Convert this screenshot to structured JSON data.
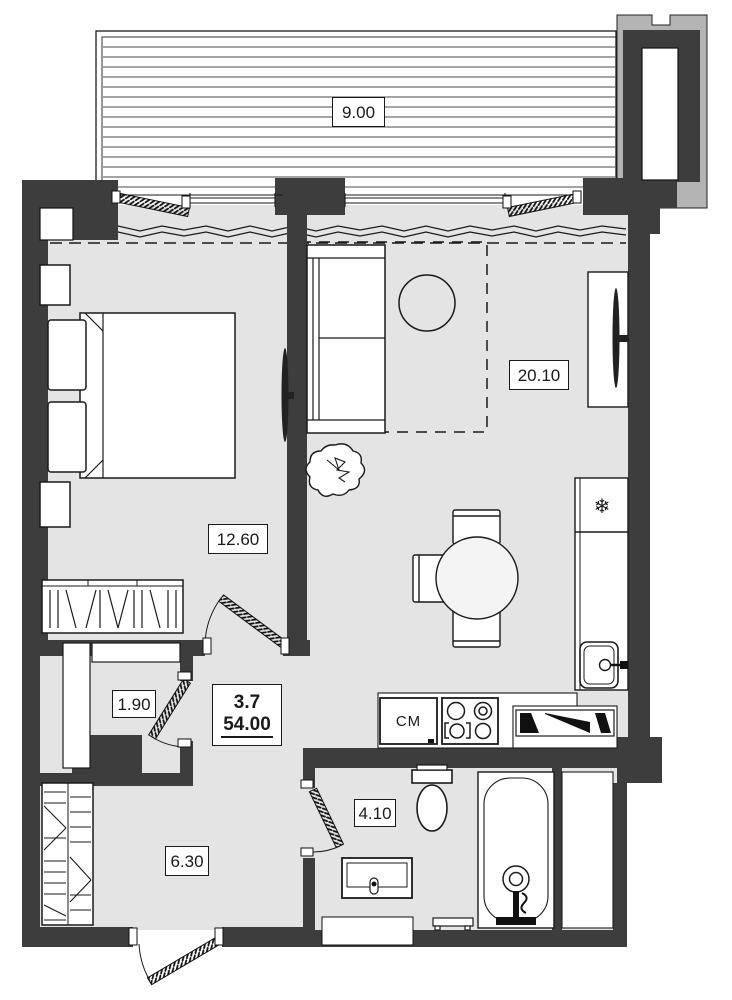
{
  "floorplan": {
    "unit": {
      "number": "3.7",
      "area_total": "54.00"
    },
    "rooms": [
      {
        "name": "balcony",
        "area": "9.00"
      },
      {
        "name": "living-kitchen",
        "area": "20.10"
      },
      {
        "name": "bedroom",
        "area": "12.60"
      },
      {
        "name": "closet",
        "area": "1.90"
      },
      {
        "name": "hallway",
        "area": "6.30"
      },
      {
        "name": "bathroom",
        "area": "4.10"
      }
    ],
    "labels": {
      "washing_machine": "СМ"
    },
    "icons": {
      "freezer_icon": "❄"
    },
    "colors": {
      "wall": "#3d3d3d",
      "floor": "#e4e4e4",
      "outline": "#1a1a1a",
      "neighbor_structure": "#b4b4b4"
    }
  }
}
